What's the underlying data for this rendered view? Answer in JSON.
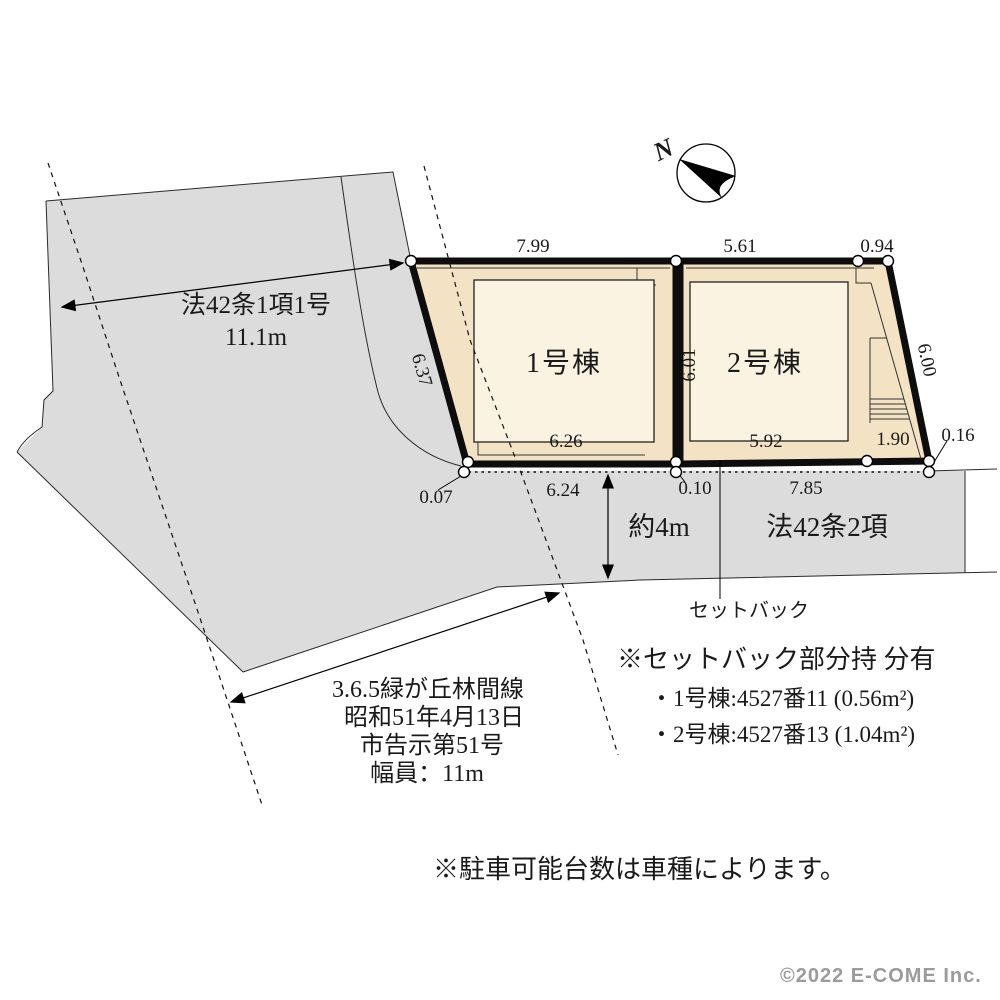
{
  "diagram": {
    "north_label": "N",
    "lot1": {
      "name": "1号棟",
      "dim_top": "7.99",
      "dim_left": "6.37",
      "dim_bottom": "6.26"
    },
    "lot2": {
      "name": "2号棟",
      "dim_top": "5.61",
      "dim_top_right": "0.94",
      "dim_left": "6.01",
      "dim_right": "6.00",
      "dim_bottom": "5.92",
      "dim_bottom_right": "1.90"
    },
    "boundary": {
      "offset_left": "0.07",
      "front_left": "6.24",
      "front_mid": "0.10",
      "front_right": "7.85",
      "offset_right": "0.16"
    },
    "side_road": {
      "label": "法42条1項1号",
      "width": "11.1m"
    },
    "front_road": {
      "width": "約4m",
      "label": "法42条2項",
      "setback": "セットバック"
    },
    "road_name_block": {
      "line1": "3.6.5緑が丘林間線",
      "line2": "昭和51年4月13日",
      "line3": "市告示第51号",
      "line4": "幅員：11m"
    },
    "notes": {
      "setback_title": "※セットバック部分持 分有",
      "setback_item1": "・1号棟:4527番11 (0.56m²)",
      "setback_item2": "・2号棟:4527番13 (1.04m²)",
      "parking": "※駐車可能台数は車種によります。"
    },
    "copyright": "©2022 E-COME Inc."
  },
  "colors": {
    "road_fill": "#dcdcdc",
    "lot_fill": "#f3e3c4",
    "building_fill": "#fbf3e2",
    "line": "#000000"
  }
}
